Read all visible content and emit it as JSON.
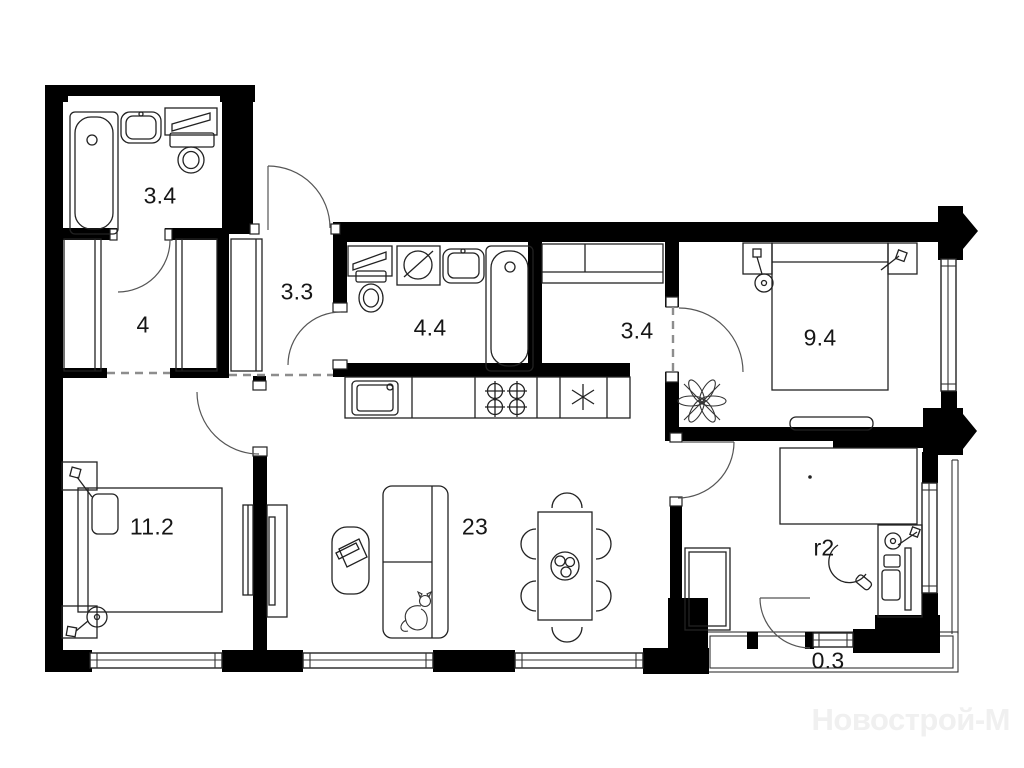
{
  "watermark": "Новострой-М",
  "rooms": [
    {
      "id": "bathroom-1",
      "label": "3.4"
    },
    {
      "id": "hallway",
      "label": "4"
    },
    {
      "id": "entry-hall",
      "label": "3.3"
    },
    {
      "id": "bathroom-2",
      "label": "4.4"
    },
    {
      "id": "corridor",
      "label": "3.4"
    },
    {
      "id": "bedroom-1",
      "label": "9.4"
    },
    {
      "id": "bedroom-2",
      "label": "11.2"
    },
    {
      "id": "living-kitchen",
      "label": "23"
    },
    {
      "id": "bedroom-3",
      "label": "r2"
    },
    {
      "id": "balcony",
      "label": "0.3"
    }
  ],
  "colors": {
    "walls": "#000000",
    "furniture_lines": "#222222",
    "labels": "#161616",
    "watermark": "#f0f0f0",
    "background": "#ffffff"
  }
}
